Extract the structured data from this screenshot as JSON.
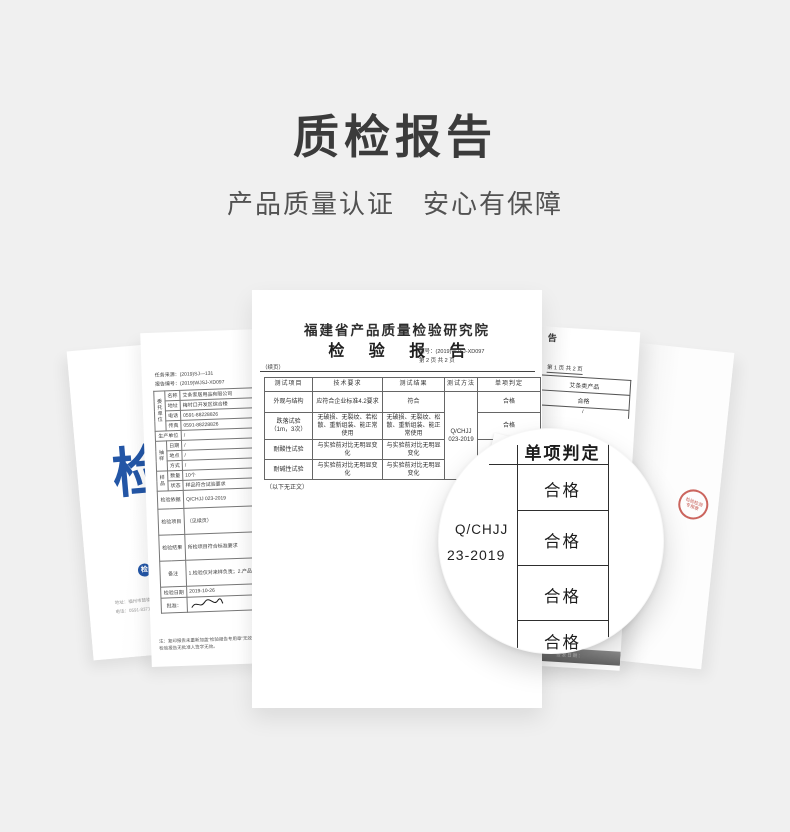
{
  "header": {
    "title": "质检报告",
    "subtitle_left": "产品质量认证",
    "subtitle_right": "安心有保障"
  },
  "cover_doc": {
    "big_char": "检",
    "logo_mark": "检",
    "org_name": "福建省产品质量检验研究院",
    "address_line1": "地址：福州市鼓楼区杨桥中路151号",
    "address_line2": "电话：0591-83713866"
  },
  "page1_doc": {
    "header_fragment": "福",
    "task_source": "任务来源：(2019)SJ—131",
    "report_no": "报告编号：(2019)WJSJ-XD097",
    "group_client": "委托单位",
    "client_rows": [
      {
        "label": "名称",
        "value": "艾条家居用品有限公司"
      },
      {
        "label": "地址",
        "value": "梅村口开发区综合楼"
      },
      {
        "label": "电话",
        "value": "0591-88228826"
      },
      {
        "label": "传真",
        "value": "0591-88228826"
      }
    ],
    "producer_label": "生产单位",
    "producer_value": "/",
    "group_sampling": "抽样",
    "sampling_rows": [
      {
        "label": "日期",
        "value": "/"
      },
      {
        "label": "地点",
        "value": "/"
      },
      {
        "label": "方式",
        "value": "/"
      }
    ],
    "group_sample": "样品",
    "sample_rows": [
      {
        "label": "数量",
        "value": "10个"
      },
      {
        "label": "状态",
        "value": "样品符合试验要求"
      }
    ],
    "basis_label": "检验依据",
    "basis_value": "Q/CHJJ 023-2019",
    "item_label": "检验项目",
    "item_value": "（见续页）",
    "result_label": "检验结果",
    "result_value": "所检项目符合标准要求",
    "remark_label": "备注",
    "remark_value": "1.检验仅对来样负责；2.产品对比评价。",
    "date_label": "检验日期",
    "date_value": "2019-10-26",
    "approve_label": "批准：",
    "note_line1": "注：复印报告未重新加盖“检验报告专用章”无效，",
    "note_line2": "检验报告无批准人签字无效。"
  },
  "main_doc": {
    "institute": "福建省产品质量检验研究院",
    "title": "检 验 报 告",
    "report_no": "编号：(2019)WJSJ-XD097",
    "page_info": "第 2 页 共 2 页",
    "continued": "（续页）",
    "table": {
      "headers": [
        "测试项目",
        "技术要求",
        "测试结果",
        "测试方法",
        "单项判定"
      ],
      "rows": [
        {
          "item": "外观与结构",
          "req": "应符合企业标准4.2要求",
          "result": "符合",
          "verdict": "合格"
        },
        {
          "item": "跌落试验",
          "item2": "（1m，3次）",
          "req": "无破损、无裂纹、若松散、重新组装、能正常使用",
          "result": "无破损、无裂纹、松散、重新组装、能正常使用",
          "verdict": "合格"
        },
        {
          "item": "耐酸性试验",
          "req": "与实验前对比无明显变化",
          "result": "与实验前对比无明显变化",
          "verdict": "合格"
        },
        {
          "item": "耐碱性试验",
          "req": "与实验前对比无明显变化",
          "result": "与实验前对比无明显变化",
          "verdict": "合格"
        }
      ],
      "method_line1": "Q/CHJJ",
      "method_line2": "023-2019"
    },
    "end_note": "（以下无正文）"
  },
  "right_doc": {
    "header_fragment": "告",
    "page_info": "第 1 页 共 2 页",
    "product_row": "艾条类产品",
    "verdict_row": "合格",
    "slash_row": "/",
    "inspector_label": "主检：",
    "footer_strip": "签发日期："
  },
  "stamp_doc": {
    "stamp_text": "检验检测专用章",
    "stamp_color": "#b93228",
    "faint_text": "·· ··· ····"
  },
  "magnifier": {
    "header": "单项判定",
    "cells": [
      "合格",
      "合格",
      "合格",
      "合格"
    ],
    "method_line1": "Q/CHJJ",
    "method_line2": "23-2019",
    "tab_mark": "、"
  }
}
